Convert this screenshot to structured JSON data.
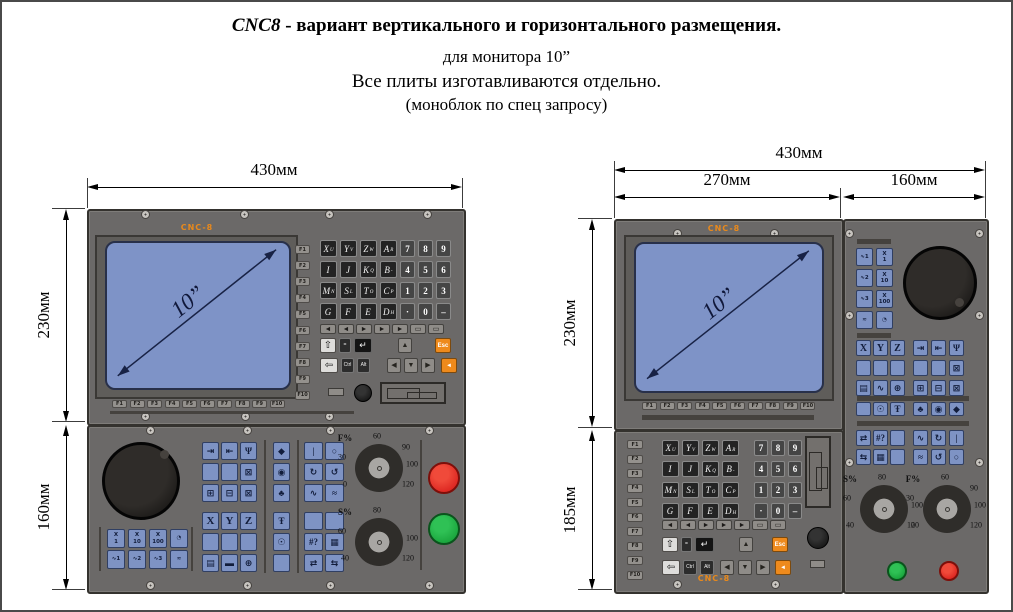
{
  "title": {
    "brand_italic": "CNC8",
    "line1_rest": " - вариант вертикального и горизонтального  размещения.",
    "line2": "для монитора 10”",
    "line3": "Все плиты изготавливаются отдельно.",
    "line4": "(моноблок по спец запросу)"
  },
  "brand_label": "CNC-8",
  "screen_diagonal": "10”",
  "dims": {
    "left_width": "430мм",
    "left_upper_height": "230мм",
    "left_lower_height": "160мм",
    "right_width": "430мм",
    "right_screen_width": "270мм",
    "right_side_width": "160мм",
    "right_upper_height": "230мм",
    "right_lower_height": "185мм"
  },
  "fkeys": [
    "F1",
    "F2",
    "F3",
    "F4",
    "F5",
    "F6",
    "F7",
    "F8",
    "F9",
    "F10"
  ],
  "keyboard": {
    "letters": [
      [
        {
          "c": "X",
          "s": "U"
        },
        {
          "c": "Y",
          "s": "V"
        },
        {
          "c": "Z",
          "s": "W"
        },
        {
          "c": "A",
          "s": "R"
        }
      ],
      [
        {
          "c": "I",
          "s": ""
        },
        {
          "c": "J",
          "s": ""
        },
        {
          "c": "K",
          "s": "Q"
        },
        {
          "c": "B",
          "s": "-"
        }
      ],
      [
        {
          "c": "M",
          "s": "N"
        },
        {
          "c": "S",
          "s": "L"
        },
        {
          "c": "T",
          "s": "O"
        },
        {
          "c": "C",
          "s": "P"
        }
      ],
      [
        {
          "c": "G",
          "s": ""
        },
        {
          "c": "F",
          "s": ""
        },
        {
          "c": "E",
          "s": ""
        },
        {
          "c": "D",
          "s": "H"
        }
      ]
    ],
    "numbers": [
      [
        "7",
        "8",
        "9"
      ],
      [
        "4",
        "5",
        "6"
      ],
      [
        "1",
        "2",
        "3"
      ],
      [
        "·",
        "0",
        "–"
      ]
    ],
    "wide_row": [
      {
        "glyph": "◄",
        "name": "wide-key-1"
      },
      {
        "glyph": "◄",
        "name": "wide-key-2"
      },
      {
        "glyph": "►",
        "name": "wide-key-3"
      },
      {
        "glyph": "►",
        "name": "wide-key-4"
      },
      {
        "glyph": "►",
        "name": "wide-key-5"
      },
      {
        "glyph": "▭",
        "name": "wide-key-6"
      },
      {
        "glyph": "▭",
        "name": "wide-key-7"
      }
    ],
    "ctrl_row1": [
      {
        "glyph": "⇧",
        "name": "up-arrow-key",
        "kind": "light"
      },
      {
        "glyph": "=",
        "name": "equals-key",
        "kind": "dark"
      },
      {
        "glyph": "↵",
        "name": "enter-key",
        "kind": "black"
      },
      {
        "glyph": "▲",
        "name": "page-up-key",
        "kind": "gray"
      },
      {
        "glyph": "Esc",
        "name": "esc-key",
        "kind": "orange"
      }
    ],
    "ctrl_row2": [
      {
        "glyph": "⇦",
        "name": "backspace-key",
        "kind": "light"
      },
      {
        "glyph": "Ctrl",
        "name": "ctrl-key",
        "kind": "dark"
      },
      {
        "glyph": "Alt",
        "name": "alt-key",
        "kind": "dark"
      },
      {
        "glyph": "◀",
        "name": "cursor-left-key",
        "kind": "gray"
      },
      {
        "glyph": "▼",
        "name": "cursor-down-key",
        "kind": "gray"
      },
      {
        "glyph": "▶",
        "name": "cursor-right-key",
        "kind": "gray"
      },
      {
        "glyph": "◄",
        "name": "input-key",
        "kind": "orange"
      }
    ]
  },
  "machine": {
    "step_rows_left": [
      [
        "X\n1",
        "X\n10",
        "X\n100",
        "◔"
      ],
      [
        "∿1",
        "∿2",
        "∿3",
        "≂"
      ]
    ],
    "step_rows_right": [
      [
        "∿1",
        "X\n1"
      ],
      [
        "∿2",
        "X\n10"
      ],
      [
        "∿3",
        "X\n100"
      ],
      [
        "≂",
        "◔"
      ]
    ],
    "group_a": [
      [
        {
          "g": "⇥",
          "n": "ref-approach-key"
        },
        {
          "g": "⇤",
          "n": "ref-return-key"
        },
        {
          "g": "Ψ",
          "n": "manual-mode-key"
        }
      ],
      [
        {
          "g": "",
          "n": "blank-key"
        },
        {
          "g": "",
          "n": "blank-key"
        },
        {
          "g": "⊠",
          "n": "tool-clamp-key"
        }
      ],
      [
        {
          "g": "⊞",
          "n": "tool-change-key"
        },
        {
          "g": "⊟",
          "n": "tool-jog-key"
        },
        {
          "g": "⊠",
          "n": "tool-set-key"
        }
      ],
      [
        {
          "g": "X",
          "n": "axis-x-key"
        },
        {
          "g": "Y",
          "n": "axis-y-key"
        },
        {
          "g": "Z",
          "n": "axis-z-key"
        }
      ],
      [
        {
          "g": "",
          "n": "blank-key"
        },
        {
          "g": "",
          "n": "blank-key"
        },
        {
          "g": "",
          "n": "blank-key"
        }
      ],
      [
        {
          "g": "▤",
          "n": "screen-key"
        },
        {
          "g": "▬",
          "n": "battery-key"
        },
        {
          "g": "⊕",
          "n": "zero-point-key"
        }
      ]
    ],
    "col_c": [
      {
        "g": "◆",
        "n": "rapid-key"
      },
      {
        "g": "◉",
        "n": "target-key"
      },
      {
        "g": "♣",
        "n": "mist-key"
      },
      {
        "g": "Ŧ",
        "n": "coolant-key"
      },
      {
        "g": "☉",
        "n": "work-light-key"
      },
      {
        "g": "",
        "n": "blank-key"
      }
    ],
    "group_d": [
      [
        {
          "g": "|",
          "n": "spindle-start-key"
        },
        {
          "g": "○",
          "n": "spindle-stop-key"
        }
      ],
      [
        {
          "g": "↻",
          "n": "spindle-cw-key"
        },
        {
          "g": "↺",
          "n": "spindle-ccw-key"
        }
      ],
      [
        {
          "g": "∿",
          "n": "chip-forward-key"
        },
        {
          "g": "≈",
          "n": "chip-reverse-key"
        }
      ],
      [
        {
          "g": "",
          "n": "blank-key"
        },
        {
          "g": "",
          "n": "blank-key"
        }
      ],
      [
        {
          "g": "#?",
          "n": "help-key"
        },
        {
          "g": "▦",
          "n": "table-key"
        }
      ],
      [
        {
          "g": "⇄",
          "n": "traverse-key"
        },
        {
          "g": "⇆",
          "n": "traverse-alt-key"
        }
      ]
    ],
    "right_mid_left": [
      [
        "X",
        "Y",
        "Z"
      ],
      [
        "",
        "",
        ""
      ],
      [
        "▤",
        "∿",
        "⊕"
      ]
    ],
    "right_mid_right": [
      [
        "⇥",
        "⇤",
        "Ψ"
      ],
      [
        "",
        "",
        "⊠"
      ],
      [
        "⊞",
        "⊟",
        "⊠"
      ]
    ],
    "right_icons_left": [
      "",
      "☉",
      "Ŧ"
    ],
    "right_icons_right": [
      "♣",
      "◉",
      "◆"
    ],
    "right_low_left": [
      [
        "⇄",
        "#?",
        ""
      ],
      [
        "⇆",
        "▦",
        ""
      ]
    ],
    "right_low_right": [
      [
        "∿",
        "↻",
        "|"
      ],
      [
        "≈",
        "↺",
        "○"
      ]
    ]
  },
  "gauges": {
    "feed": {
      "label": "F%",
      "ticks": {
        "top": "60",
        "left": "30",
        "right_top": "90",
        "right": "100",
        "bottom_left": "0",
        "bottom_right": "120"
      }
    },
    "spindle": {
      "label": "S%",
      "ticks": {
        "top": "80",
        "left": "60",
        "right": "100",
        "bottom_left": "40",
        "bottom_right": "120"
      }
    }
  },
  "colors": {
    "panel": "#6b6968",
    "key-blue": "#7e93c4",
    "screen-blue": "#7e93c7",
    "orange": "#ee8a1c",
    "brand-orange": "#e8891c",
    "stop-red": "#e01f1f",
    "start-green": "#14a032",
    "dim-line": "#000000"
  }
}
